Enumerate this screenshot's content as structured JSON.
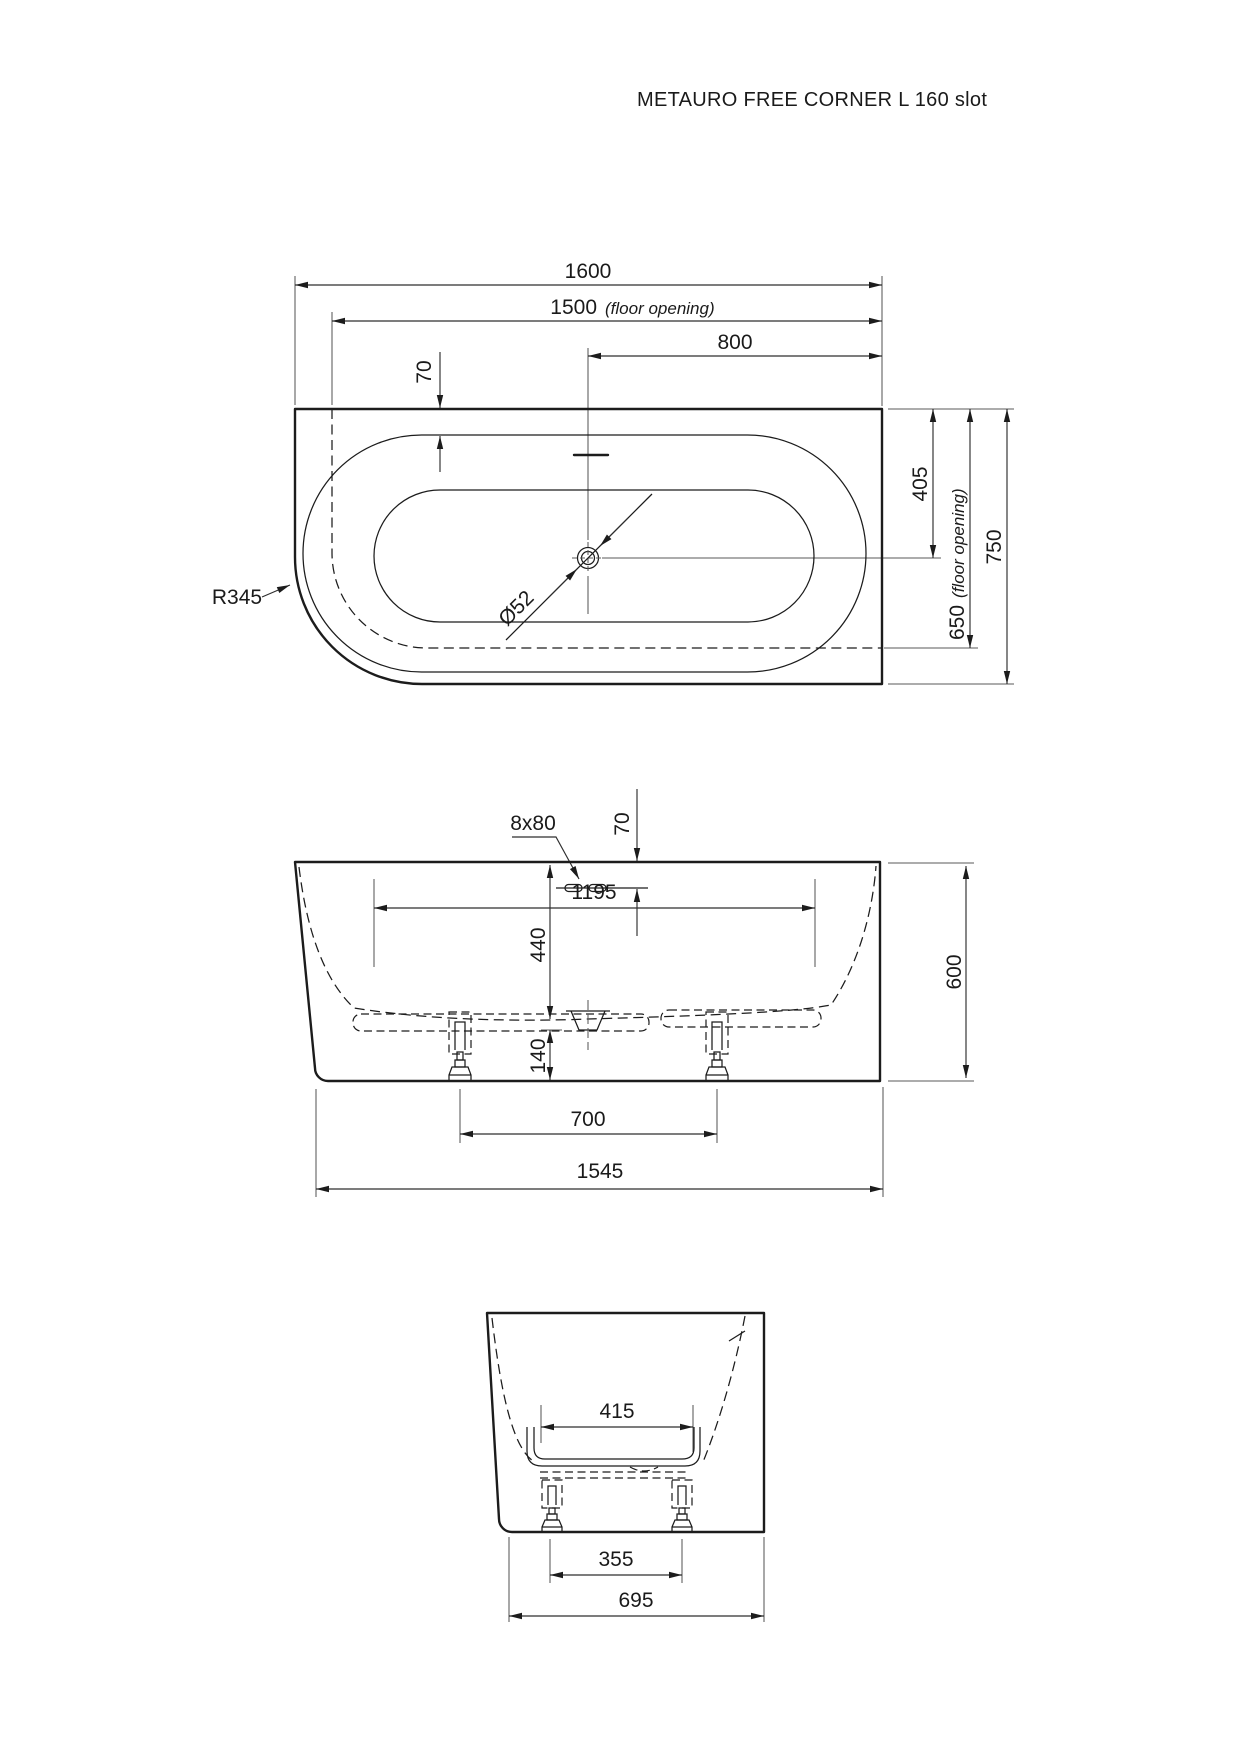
{
  "title": "METAURO FREE CORNER L 160 slot",
  "top_view": {
    "overall_length": "1600",
    "floor_opening_length": "1500",
    "floor_opening_length_note": "(floor opening)",
    "drain_to_right_edge": "800",
    "rim_width": "70",
    "drain_diameter": "Ø52",
    "corner_radius": "R345",
    "drain_to_top_edge": "405",
    "floor_opening_width": "650",
    "floor_opening_width_note": "(floor opening)",
    "overall_width": "750"
  },
  "front_view": {
    "overflow_slot": "8x80",
    "slot_offset": "70",
    "inner_depth": "440",
    "inner_floor_length": "1195",
    "underbody_clearance": "140",
    "feet_spacing": "700",
    "base_length": "1545",
    "overall_height": "600"
  },
  "side_view": {
    "inner_floor_width": "415",
    "feet_spacing": "355",
    "base_width": "695"
  }
}
